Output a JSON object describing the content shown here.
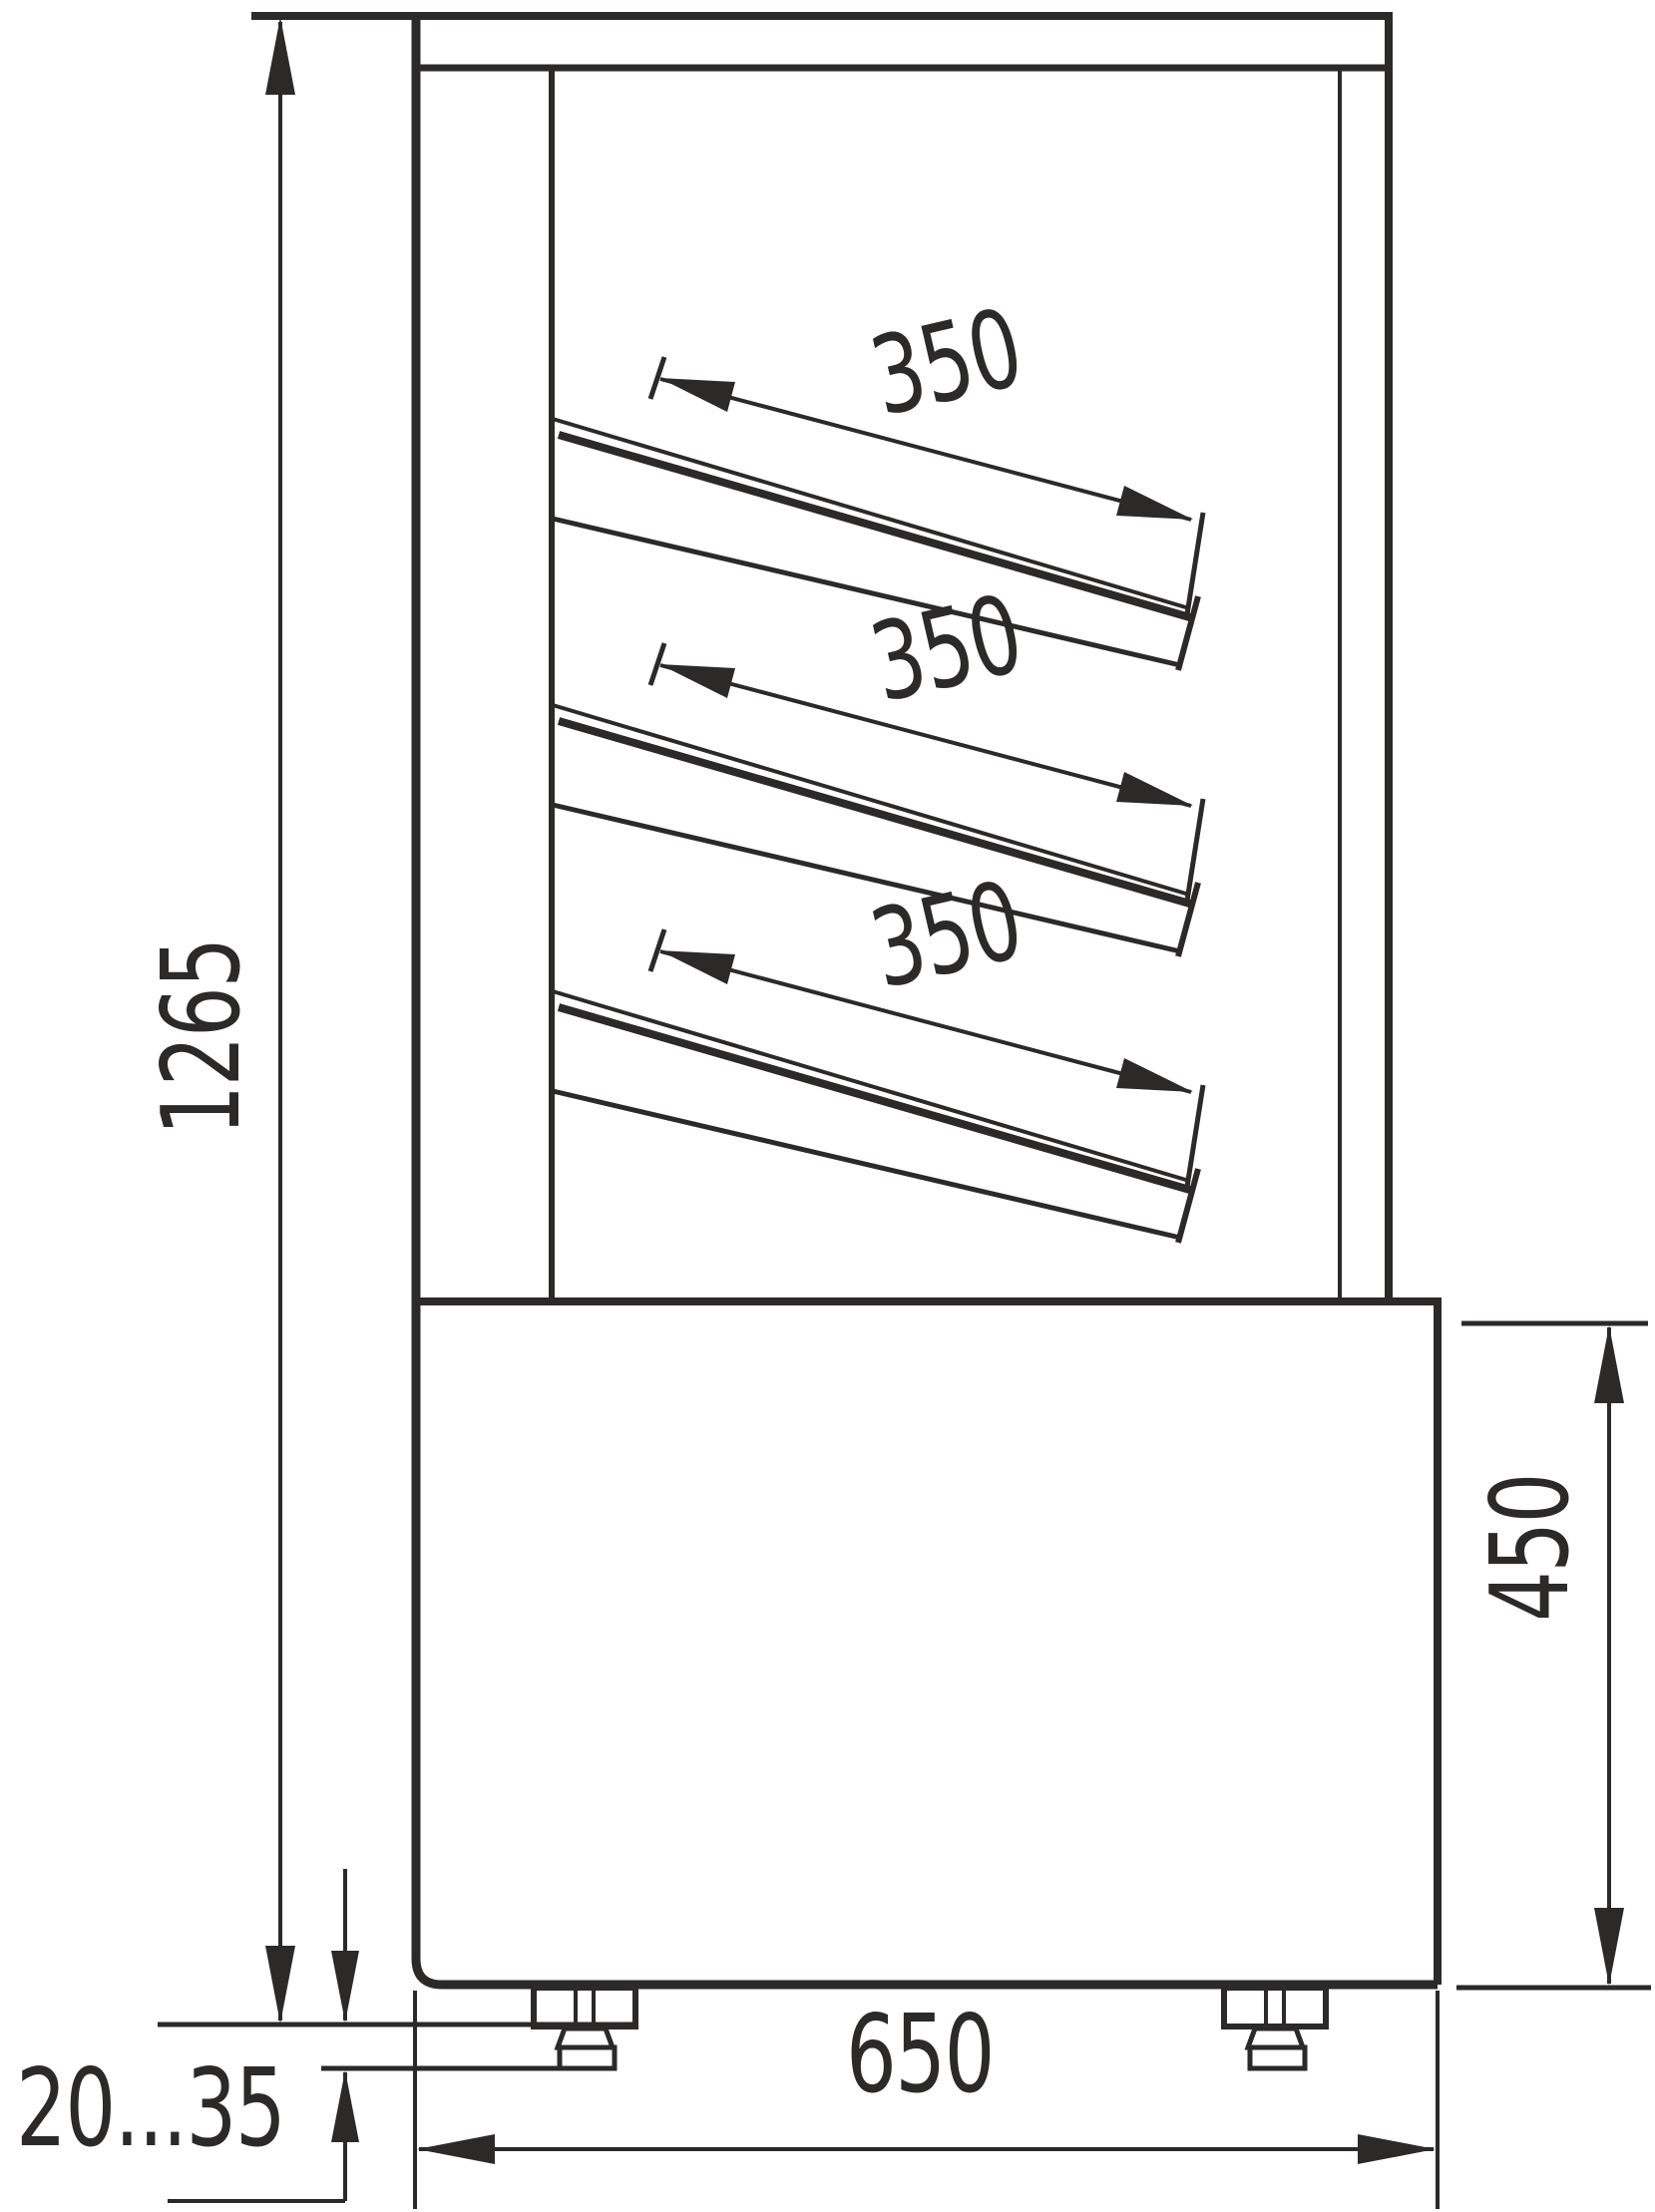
{
  "drawing": {
    "type": "technical-dimension-drawing",
    "subject": "refrigerated display case side view",
    "line_color": "#2b2a29",
    "background_color": "#ffffff",
    "dimensions": {
      "overall_height": {
        "value": "1265"
      },
      "shelf_depths": [
        {
          "value": "350"
        },
        {
          "value": "350"
        },
        {
          "value": "350"
        }
      ],
      "base_height": {
        "value": "450"
      },
      "base_depth": {
        "value": "650"
      },
      "leg_adjust_range": {
        "value": "20...35"
      }
    }
  }
}
